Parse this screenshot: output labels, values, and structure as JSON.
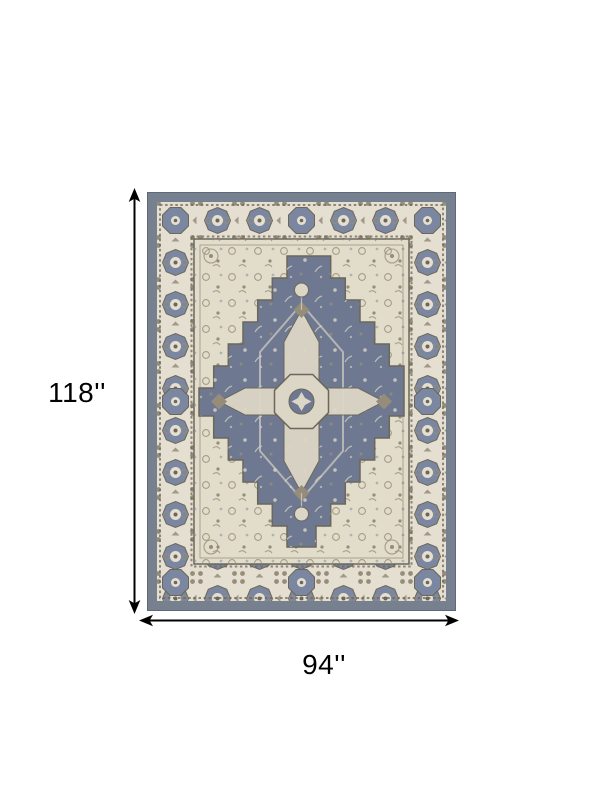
{
  "page": {
    "background_color": "#ffffff"
  },
  "dimensions": {
    "height_label": "118''",
    "width_label": "94''",
    "arrow_color": "#000000",
    "label_color": "#000000"
  },
  "rug": {
    "colors": {
      "outer_border": "#76808F",
      "outer_border_edge": "#5D6878",
      "band": "#E5DFD2",
      "motif_blue": "#7B87A0",
      "motif_taupe": "#958D79",
      "outline": "#6B675A",
      "field_ivory": "#E2DCCB",
      "diamond": "#6E7890",
      "medallion": "#DCD6C6"
    }
  }
}
